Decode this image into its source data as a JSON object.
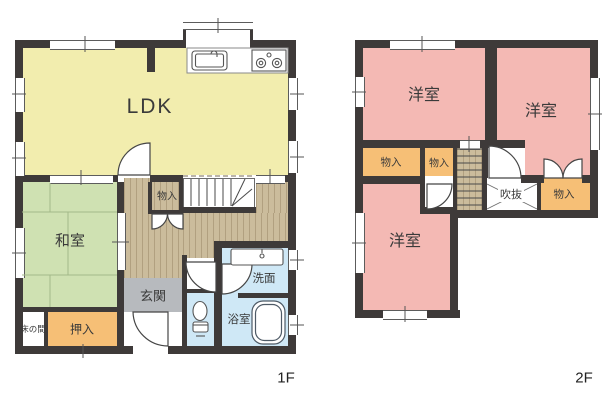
{
  "colors": {
    "wall": "#3e3a39",
    "ldk": "#f2edae",
    "tatami": "#cfe1b2",
    "western": "#f4b9b4",
    "storage": "#f6bf76",
    "entrance": "#b7babe",
    "bath": "#cfe8f6",
    "wood": "#cbbc9c",
    "ink": "#3a3a3a"
  },
  "floor1": {
    "label": "1F",
    "rooms": {
      "ldk": "LDK",
      "washitsu": "和室",
      "genkan": "玄関",
      "senmen": "洗面",
      "yokushitsu": "浴室",
      "monoire": "物入",
      "oshiire": "押入",
      "tokonoma": "床の間"
    }
  },
  "floor2": {
    "label": "2F",
    "rooms": {
      "yoshitsu_top_left": "洋室",
      "yoshitsu_top_right": "洋室",
      "yoshitsu_bottom": "洋室",
      "monoire_left": "物入",
      "monoire_mid": "物入",
      "monoire_right": "物入",
      "fukinuke": "吹抜"
    }
  }
}
